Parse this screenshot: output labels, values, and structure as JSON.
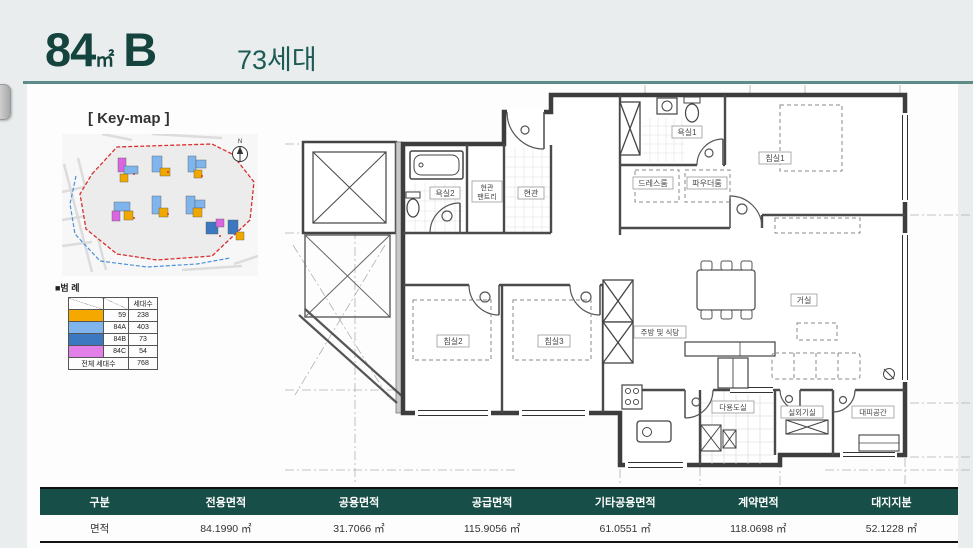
{
  "header": {
    "area_number": "84",
    "area_unit": "㎡",
    "type_letter": "B",
    "households": "73세대"
  },
  "keymap": {
    "title": "[ Key-map ]",
    "north_label": "N"
  },
  "legend": {
    "title": "■범 례",
    "col_header": "세대수",
    "rows": [
      {
        "label": "59",
        "count": "238",
        "color": "#F5A800"
      },
      {
        "label": "84A",
        "count": "403",
        "color": "#7FB5EC"
      },
      {
        "label": "84B",
        "count": "73",
        "color": "#3C78C0"
      },
      {
        "label": "84C",
        "count": "54",
        "color": "#E27FE8"
      }
    ],
    "total_label": "전체 세대수",
    "total_count": "768"
  },
  "floorplan": {
    "labels": {
      "bath2": "욕실2",
      "pantry_line1": "현관",
      "pantry_line2": "팬트리",
      "entry": "현관",
      "bath1": "욕실1",
      "dress_room": "드레스룸",
      "powder_room": "파우더룸",
      "bedroom1": "침실1",
      "bedroom2": "침실2",
      "bedroom3": "침실3",
      "living": "거실",
      "kitchen": "주방 및 식당",
      "utility": "다용도실",
      "ac_room": "실외기실",
      "refuge": "대피공간"
    }
  },
  "area_table": {
    "headers": [
      "구분",
      "전용면적",
      "공용면적",
      "공급면적",
      "기타공용면적",
      "계약면적",
      "대지지분"
    ],
    "row_label": "면적",
    "values": [
      "84.1990 ㎡",
      "31.7066 ㎡",
      "115.9056 ㎡",
      "61.0551 ㎡",
      "118.0698 ㎡",
      "52.1228 ㎡"
    ]
  }
}
